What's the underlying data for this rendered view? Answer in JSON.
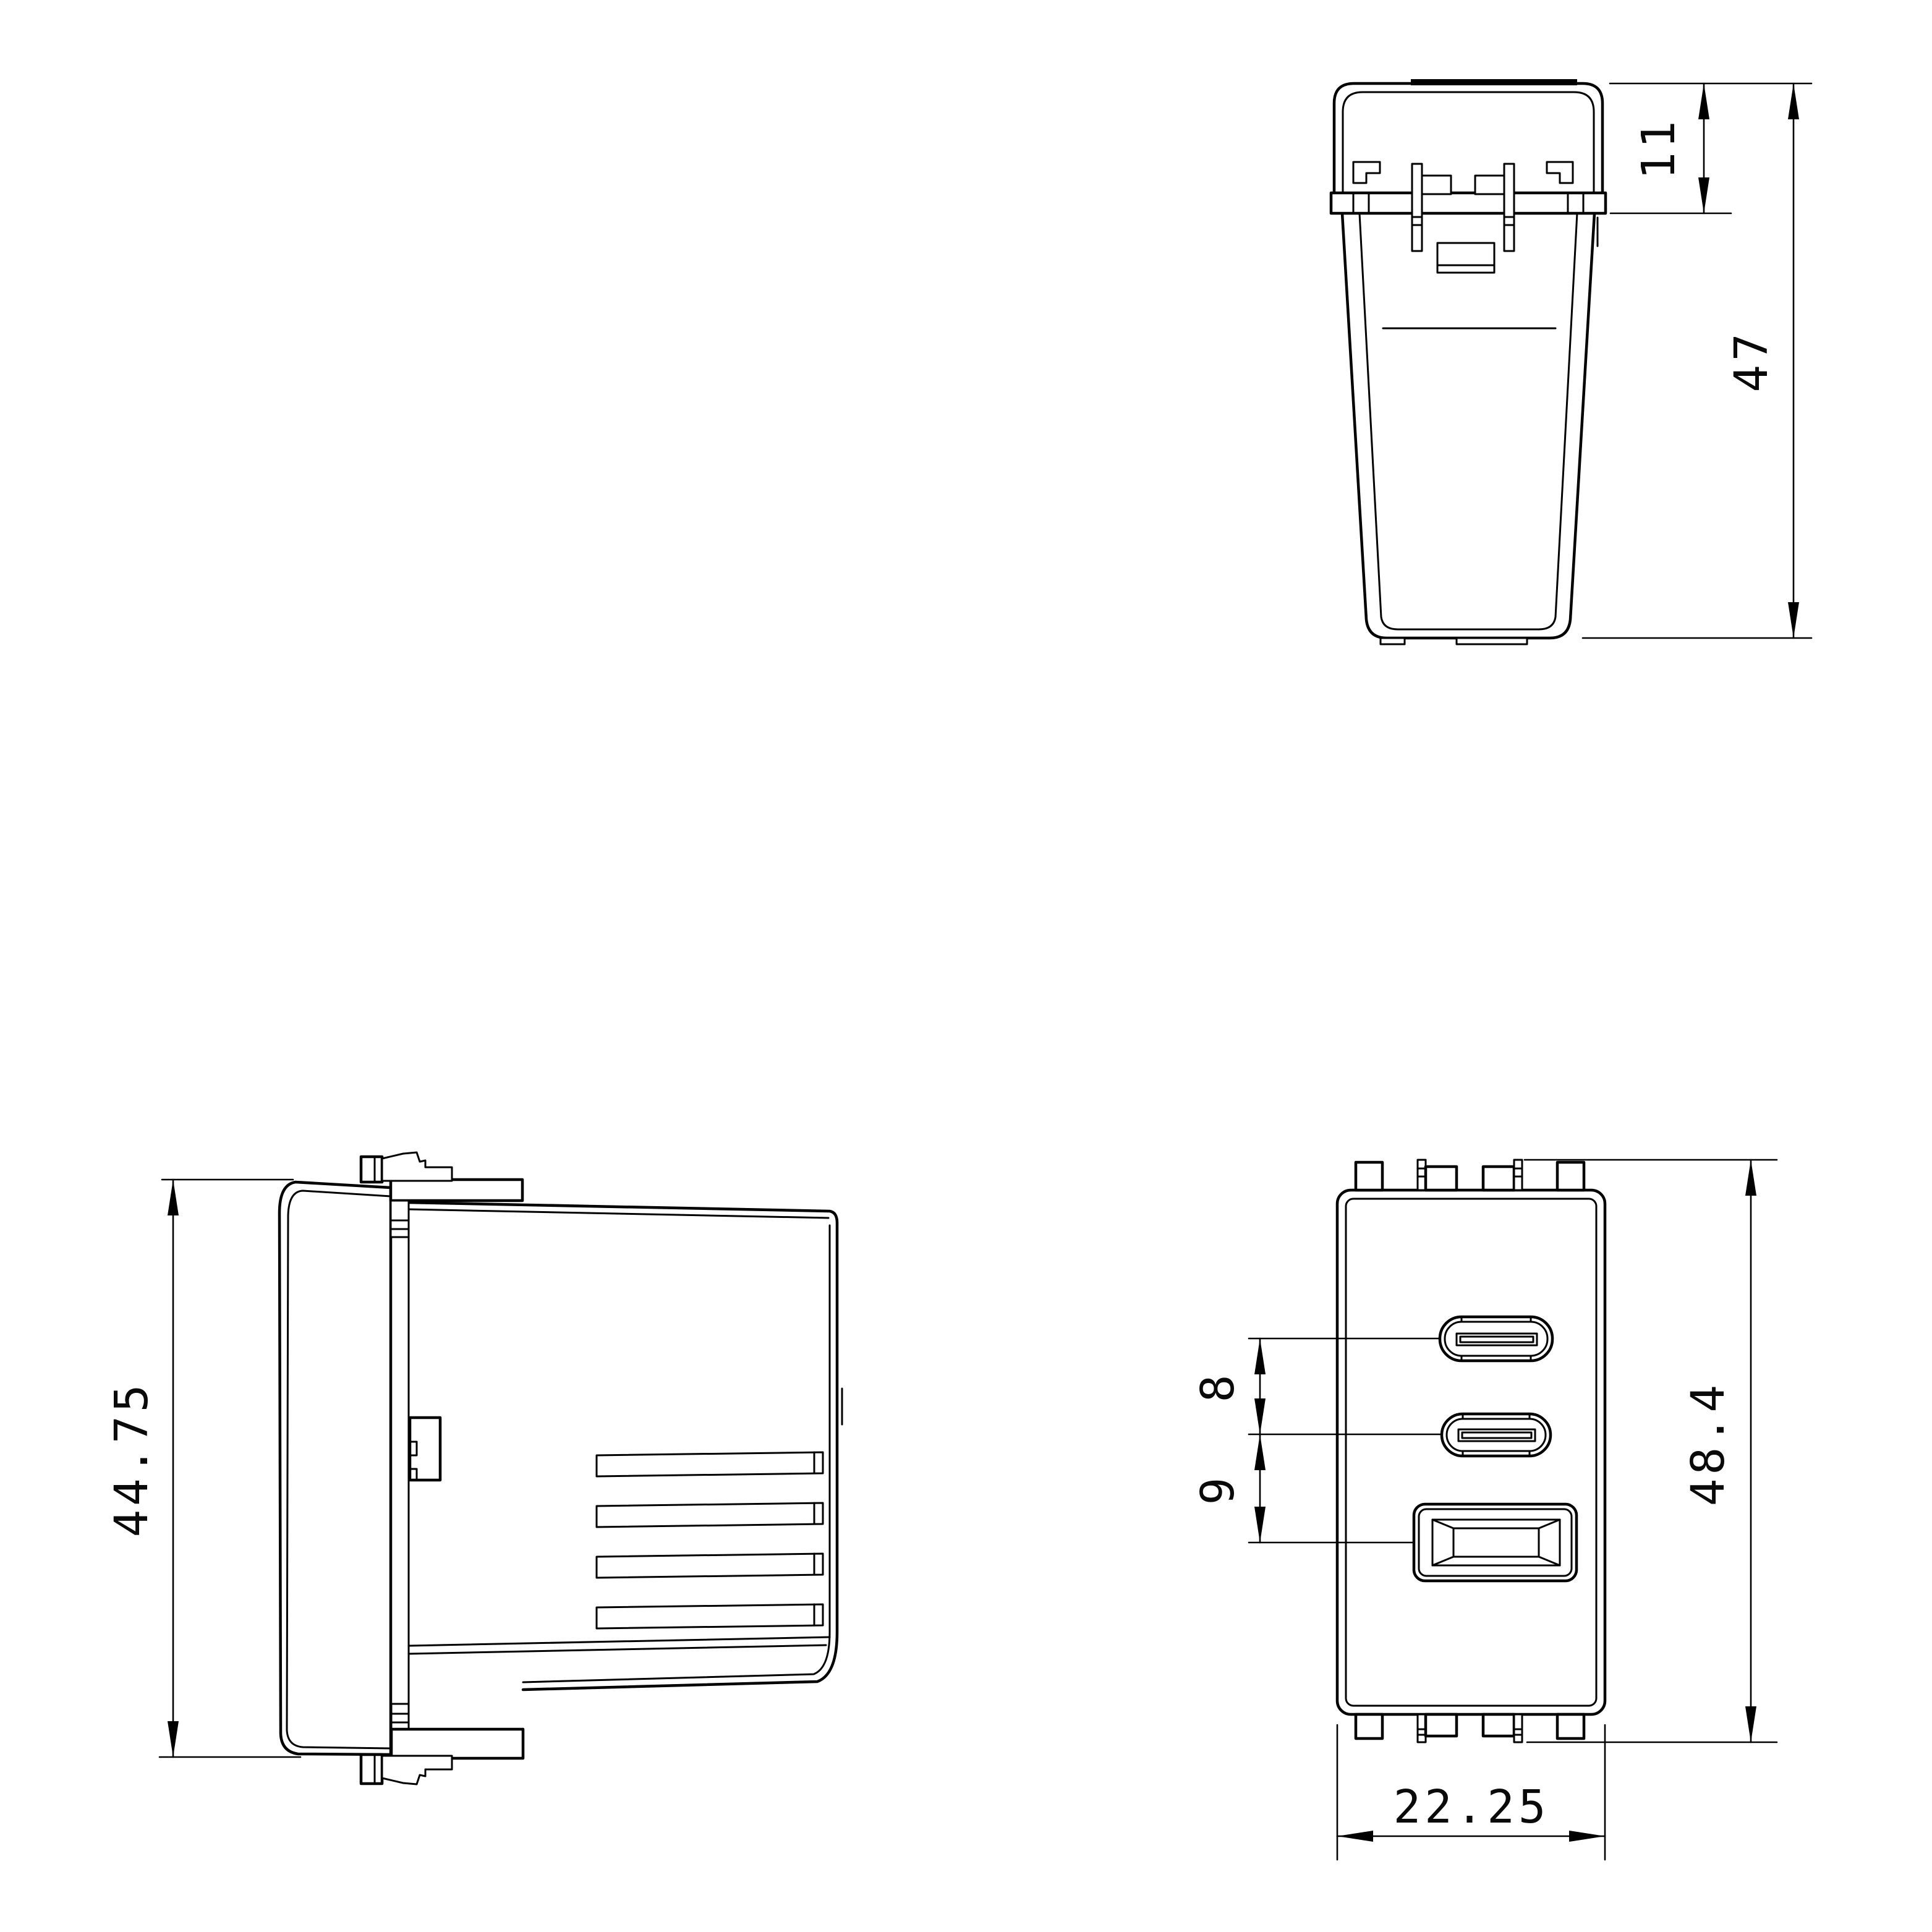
{
  "page": {
    "background_color": "#ffffff",
    "line_color": "#000000"
  },
  "dimensions": {
    "clip_depth": "11",
    "total_depth": "47",
    "side_height": "44.75",
    "usb_c_spacing": "8",
    "usb_a_spacing": "9",
    "front_height": "48.4",
    "front_width": "22.25"
  }
}
